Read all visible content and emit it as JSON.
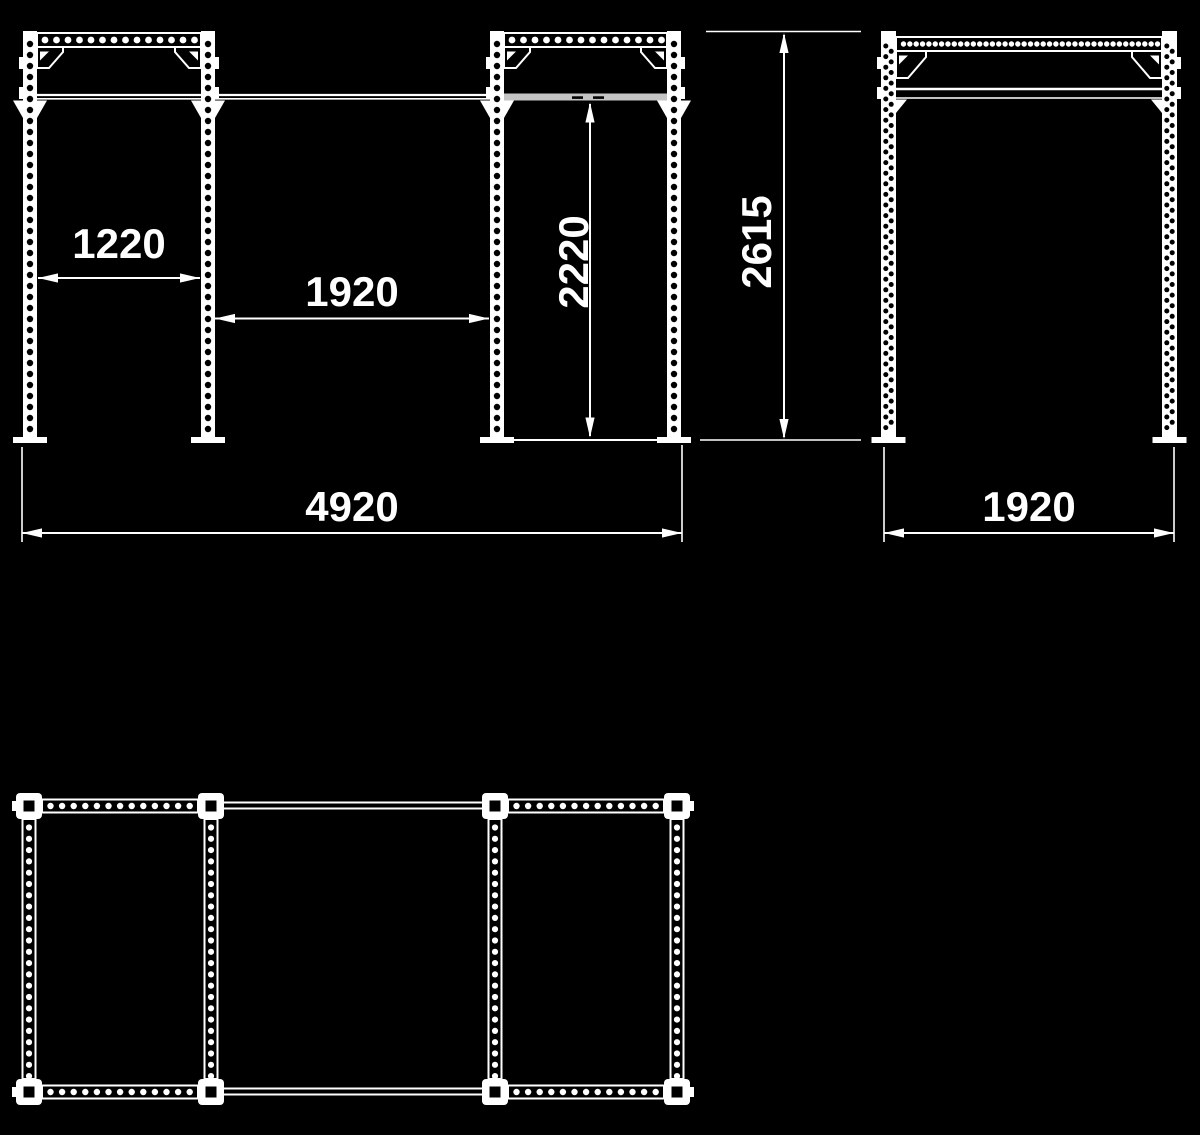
{
  "drawing": {
    "background_color": "#000000",
    "line_color": "#ffffff",
    "bar_highlight_color": "#c4c4c4",
    "dimensions": {
      "front_bay_left_width": "1220",
      "front_bay_middle_width": "1920",
      "pullup_bar_height": "2220",
      "overall_height": "2615",
      "overall_width": "4920",
      "side_depth": "1920"
    }
  }
}
